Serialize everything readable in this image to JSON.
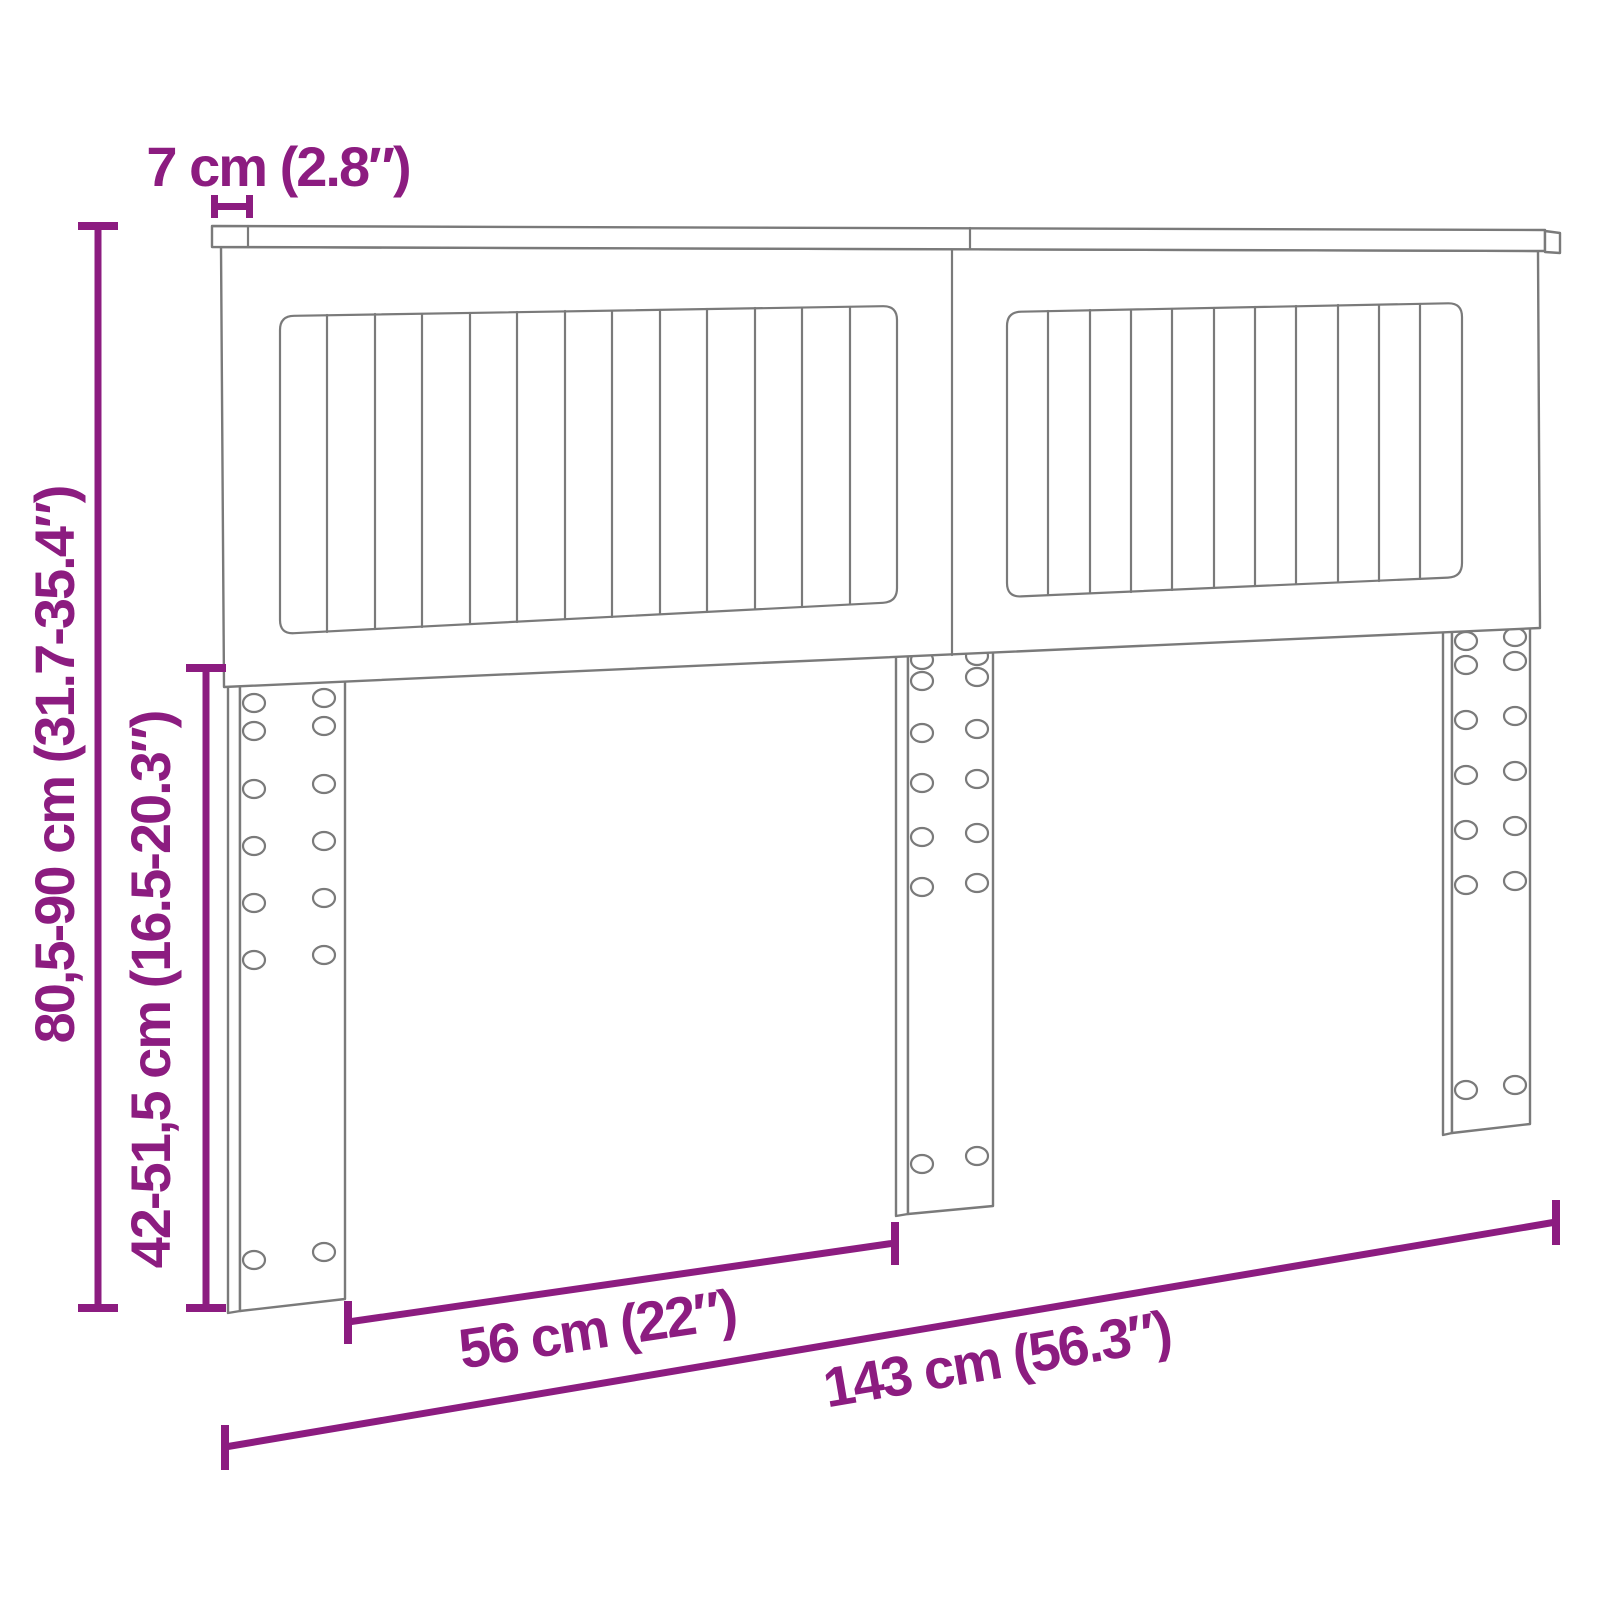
{
  "title": "Headboard dimension diagram",
  "product": "headboard with three mounting legs",
  "colors": {
    "dimension_accent": "#8C1C80",
    "drawing_outline": "#7a7a7a",
    "background": "#ffffff"
  },
  "dimensions": {
    "top_rail_thickness": "7 cm (2.8″)",
    "overall_height": "80,5-90 cm (31.7-35.4″)",
    "leg_height": "42-51,5 cm (16.5-20.3″)",
    "leg_spacing": "56 cm (22″)",
    "overall_width": "143 cm (56.3″)"
  }
}
